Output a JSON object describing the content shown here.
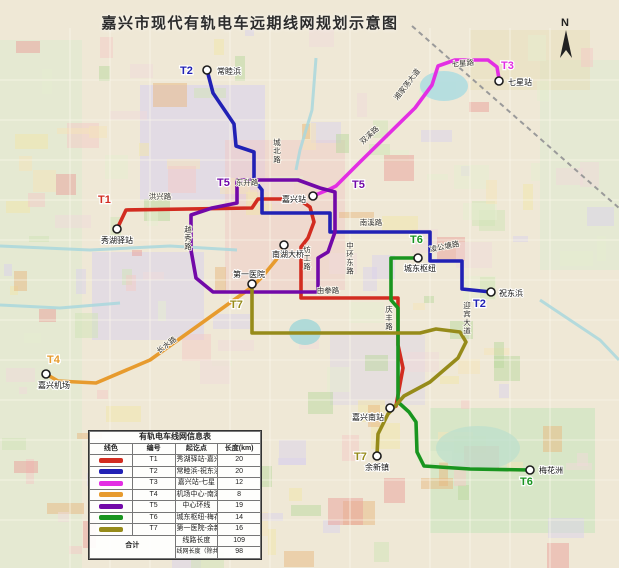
{
  "title": "嘉兴市现代有轨电车远期线网规划示意图",
  "compass": {
    "label": "N"
  },
  "legend": {
    "title": "有轨电车线网信息表",
    "headers": [
      "线色",
      "编号",
      "起讫点",
      "长度(km)"
    ],
    "rows": [
      {
        "no": "T1",
        "color": "#d22c20",
        "route": "秀湖驿站-嘉兴南站",
        "length": "20"
      },
      {
        "no": "T2",
        "color": "#2121b5",
        "route": "常睦浜-祝东浜",
        "length": "20"
      },
      {
        "no": "T3",
        "color": "#e32ee3",
        "route": "嘉兴站-七星",
        "length": "12"
      },
      {
        "no": "T4",
        "color": "#e79b2e",
        "route": "机场中心-南湖大桥",
        "length": "8"
      },
      {
        "no": "T5",
        "color": "#7209a8",
        "route": "中心环线",
        "length": "19"
      },
      {
        "no": "T6",
        "color": "#19951f",
        "route": "城东枢纽-梅花洲",
        "length": "14"
      },
      {
        "no": "T7",
        "color": "#968b1a",
        "route": "第一医院-余新镇",
        "length": "16"
      }
    ],
    "total_label": "合计",
    "totals": [
      {
        "label": "线路长度",
        "value": "109"
      },
      {
        "label": "线网长度（除共线段长度）",
        "value": "98"
      }
    ]
  },
  "map": {
    "lines": [
      {
        "id": "T1",
        "color": "#d22c20",
        "points": [
          [
            117,
            229
          ],
          [
            126,
            210
          ],
          [
            252,
            208
          ],
          [
            258,
            199
          ],
          [
            298,
            199
          ],
          [
            310,
            207
          ],
          [
            314,
            222
          ],
          [
            308,
            238
          ],
          [
            301,
            247
          ],
          [
            301,
            298
          ],
          [
            398,
            298
          ],
          [
            398,
            345
          ],
          [
            403,
            368
          ],
          [
            396,
            406
          ]
        ]
      },
      {
        "id": "T2",
        "color": "#2121b5",
        "points": [
          [
            207,
            70
          ],
          [
            213,
            93
          ],
          [
            234,
            124
          ],
          [
            236,
            146
          ],
          [
            254,
            152
          ],
          [
            254,
            180
          ],
          [
            262,
            190
          ],
          [
            262,
            213
          ],
          [
            330,
            213
          ],
          [
            330,
            232
          ],
          [
            430,
            232
          ],
          [
            430,
            261
          ],
          [
            462,
            261
          ],
          [
            462,
            289
          ],
          [
            491,
            292
          ]
        ]
      },
      {
        "id": "T3",
        "color": "#e32ee3",
        "points": [
          [
            313,
            196
          ],
          [
            330,
            189
          ],
          [
            336,
            186
          ],
          [
            360,
            162
          ],
          [
            415,
            108
          ],
          [
            432,
            85
          ],
          [
            438,
            66
          ],
          [
            455,
            60
          ],
          [
            488,
            60
          ],
          [
            497,
            67
          ],
          [
            499,
            79
          ]
        ]
      },
      {
        "id": "T4",
        "color": "#e79b2e",
        "points": [
          [
            46,
            374
          ],
          [
            58,
            381
          ],
          [
            96,
            383
          ],
          [
            150,
            360
          ],
          [
            252,
            287
          ],
          [
            262,
            277
          ],
          [
            276,
            260
          ],
          [
            284,
            247
          ]
        ]
      },
      {
        "id": "T5",
        "color": "#7209a8",
        "closed": true,
        "points": [
          [
            237,
            180
          ],
          [
            298,
            180
          ],
          [
            320,
            188
          ],
          [
            335,
            192
          ],
          [
            335,
            232
          ],
          [
            328,
            252
          ],
          [
            318,
            258
          ],
          [
            318,
            292
          ],
          [
            213,
            292
          ],
          [
            196,
            278
          ],
          [
            191,
            250
          ],
          [
            191,
            215
          ],
          [
            212,
            208
          ],
          [
            237,
            203
          ]
        ]
      },
      {
        "id": "T6",
        "color": "#19951f",
        "points": [
          [
            418,
            258
          ],
          [
            391,
            258
          ],
          [
            391,
            300
          ],
          [
            398,
            308
          ],
          [
            398,
            402
          ],
          [
            409,
            412
          ],
          [
            416,
            422
          ],
          [
            417,
            452
          ],
          [
            424,
            466
          ],
          [
            470,
            469
          ],
          [
            530,
            470
          ]
        ]
      },
      {
        "id": "T7",
        "color": "#968b1a",
        "points": [
          [
            252,
            284
          ],
          [
            252,
            333
          ],
          [
            420,
            333
          ],
          [
            436,
            329
          ],
          [
            460,
            332
          ],
          [
            466,
            342
          ],
          [
            458,
            358
          ],
          [
            430,
            382
          ],
          [
            404,
            396
          ],
          [
            388,
            414
          ],
          [
            378,
            434
          ],
          [
            377,
            455
          ]
        ]
      }
    ],
    "stations": [
      {
        "x": 117,
        "y": 229,
        "label": "秀湖驿站",
        "lx": 117,
        "ly": 243,
        "anchor": "middle"
      },
      {
        "x": 207,
        "y": 70,
        "label": "常睦浜",
        "lx": 217,
        "ly": 74,
        "anchor": "start"
      },
      {
        "x": 499,
        "y": 81,
        "label": "七星站",
        "lx": 508,
        "ly": 85,
        "anchor": "start"
      },
      {
        "x": 313,
        "y": 196,
        "label": "嘉兴站",
        "lx": 306,
        "ly": 202,
        "anchor": "end"
      },
      {
        "x": 284,
        "y": 245,
        "label": "南湖大桥",
        "lx": 288,
        "ly": 257,
        "anchor": "middle"
      },
      {
        "x": 252,
        "y": 284,
        "label": "第一医院",
        "lx": 249,
        "ly": 277,
        "anchor": "middle"
      },
      {
        "x": 418,
        "y": 258,
        "label": "城东枢纽",
        "lx": 420,
        "ly": 271,
        "anchor": "middle"
      },
      {
        "x": 491,
        "y": 292,
        "label": "祝东浜",
        "lx": 499,
        "ly": 296,
        "anchor": "start"
      },
      {
        "x": 46,
        "y": 374,
        "label": "嘉兴机场",
        "lx": 54,
        "ly": 388,
        "anchor": "middle"
      },
      {
        "x": 390,
        "y": 408,
        "label": "嘉兴南站",
        "lx": 384,
        "ly": 420,
        "anchor": "end"
      },
      {
        "x": 377,
        "y": 456,
        "label": "余新镇",
        "lx": 377,
        "ly": 470,
        "anchor": "middle"
      },
      {
        "x": 530,
        "y": 470,
        "label": "梅花洲",
        "lx": 539,
        "ly": 473,
        "anchor": "start"
      }
    ],
    "badges": [
      {
        "text": "T1",
        "x": 98,
        "y": 203,
        "color": "#d22c20"
      },
      {
        "text": "T2",
        "x": 180,
        "y": 74,
        "color": "#2121b5"
      },
      {
        "text": "T2",
        "x": 473,
        "y": 307,
        "color": "#2121b5"
      },
      {
        "text": "T3",
        "x": 501,
        "y": 69,
        "color": "#e32ee3"
      },
      {
        "text": "T4",
        "x": 47,
        "y": 363,
        "color": "#e79b2e"
      },
      {
        "text": "T5",
        "x": 217,
        "y": 186,
        "color": "#7209a8"
      },
      {
        "text": "T5",
        "x": 352,
        "y": 188,
        "color": "#7209a8"
      },
      {
        "text": "T6",
        "x": 410,
        "y": 243,
        "color": "#19951f"
      },
      {
        "text": "T6",
        "x": 520,
        "y": 485,
        "color": "#19951f"
      },
      {
        "text": "T7",
        "x": 230,
        "y": 308,
        "color": "#968b1a"
      },
      {
        "text": "T7",
        "x": 354,
        "y": 460,
        "color": "#968b1a"
      }
    ],
    "road_labels": [
      {
        "text": "洪兴路",
        "x": 160,
        "y": 199
      },
      {
        "text": "东升路",
        "x": 247,
        "y": 185
      },
      {
        "text": "越秀路",
        "x": 188,
        "y": 232,
        "vertical": true
      },
      {
        "text": "城北路",
        "x": 277,
        "y": 145,
        "vertical": true
      },
      {
        "text": "双溪路",
        "x": 371,
        "y": 137,
        "rotate": -42
      },
      {
        "text": "湘家荡大道",
        "x": 409,
        "y": 86,
        "rotate": -52
      },
      {
        "text": "七星路",
        "x": 463,
        "y": 66,
        "rotate": -6
      },
      {
        "text": "南溪路",
        "x": 371,
        "y": 225
      },
      {
        "text": "纺工路",
        "x": 307,
        "y": 252,
        "vertical": true
      },
      {
        "text": "中环东路",
        "x": 350,
        "y": 248,
        "vertical": true
      },
      {
        "text": "凌公塘路",
        "x": 445,
        "y": 249,
        "rotate": -12
      },
      {
        "text": "迎宾大道",
        "x": 467,
        "y": 308,
        "vertical": true
      },
      {
        "text": "由拳路",
        "x": 328,
        "y": 293
      },
      {
        "text": "庆丰路",
        "x": 389,
        "y": 312,
        "vertical": true
      },
      {
        "text": "长水路",
        "x": 168,
        "y": 347,
        "rotate": -37
      }
    ]
  }
}
